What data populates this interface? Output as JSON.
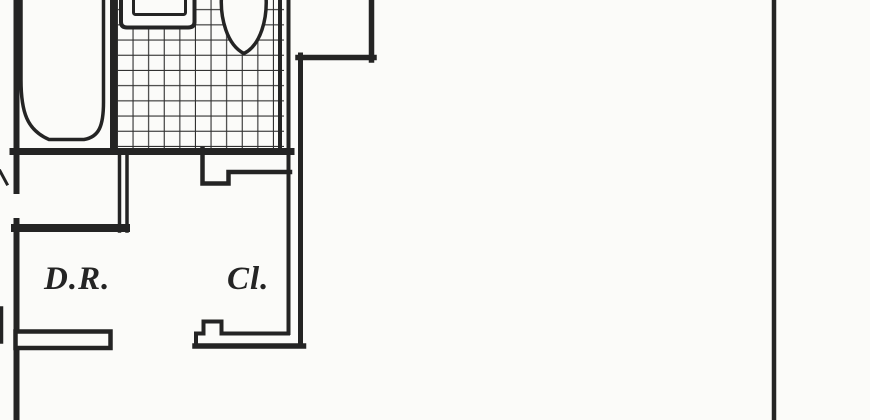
{
  "document": {
    "kind_label": "floor-plan-drawing"
  },
  "colors": {
    "ink": "#242424",
    "tile_ink": "#2f2f2f",
    "paper": "#fbfbf9"
  },
  "rooms": [
    {
      "id": "dining-room",
      "label": "D.R."
    },
    {
      "id": "closet",
      "label": "Cl."
    }
  ],
  "fixtures": [
    {
      "name": "bathtub-icon"
    },
    {
      "name": "sink-icon"
    },
    {
      "name": "toilet-icon"
    },
    {
      "name": "tiled-floor"
    }
  ]
}
